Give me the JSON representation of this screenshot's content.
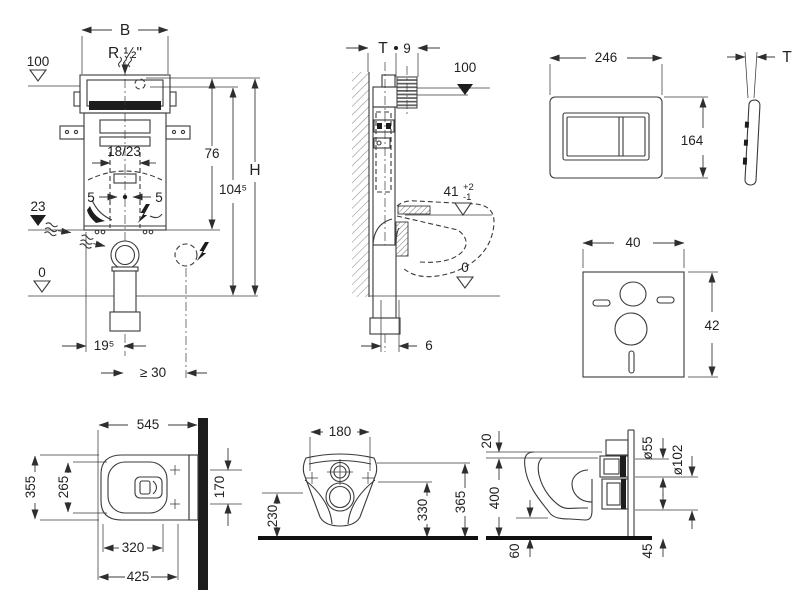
{
  "colors": {
    "line": "#3a3a3a",
    "text": "#222222",
    "fill_dark": "#1d1d1d",
    "background": "#ffffff"
  },
  "cistern_front": {
    "label_b": "B",
    "label_r": "R ½\"",
    "label_100": "100",
    "label_1823": "18/23",
    "label_5_left": "5",
    "label_5_right": "5",
    "label_76": "76",
    "label_h": "H",
    "label_1045": "104⁵",
    "label_23": "23",
    "label_0": "0",
    "label_195": "19⁵",
    "label_ge30": "≥ 30"
  },
  "cistern_side": {
    "label_t": "T",
    "label_9": "9",
    "label_100": "100",
    "label_41": "41",
    "tol_plus": "+2",
    "tol_minus": "-1",
    "label_0": "0",
    "label_6": "6"
  },
  "flush_plate": {
    "label_width": "246",
    "label_height": "164",
    "label_t": "T"
  },
  "insulation_mat": {
    "label_width": "40",
    "label_height": "42"
  },
  "pan_top": {
    "label_545": "545",
    "label_355": "355",
    "label_265": "265",
    "label_170": "170",
    "label_320": "320",
    "label_425": "425"
  },
  "pan_front": {
    "label_180": "180",
    "label_230": "230",
    "label_330": "330",
    "label_365": "365"
  },
  "pan_side": {
    "label_20": "20",
    "label_400": "400",
    "label_60": "60",
    "label_d55": "ø55",
    "label_d102": "ø102",
    "label_45": "45"
  }
}
